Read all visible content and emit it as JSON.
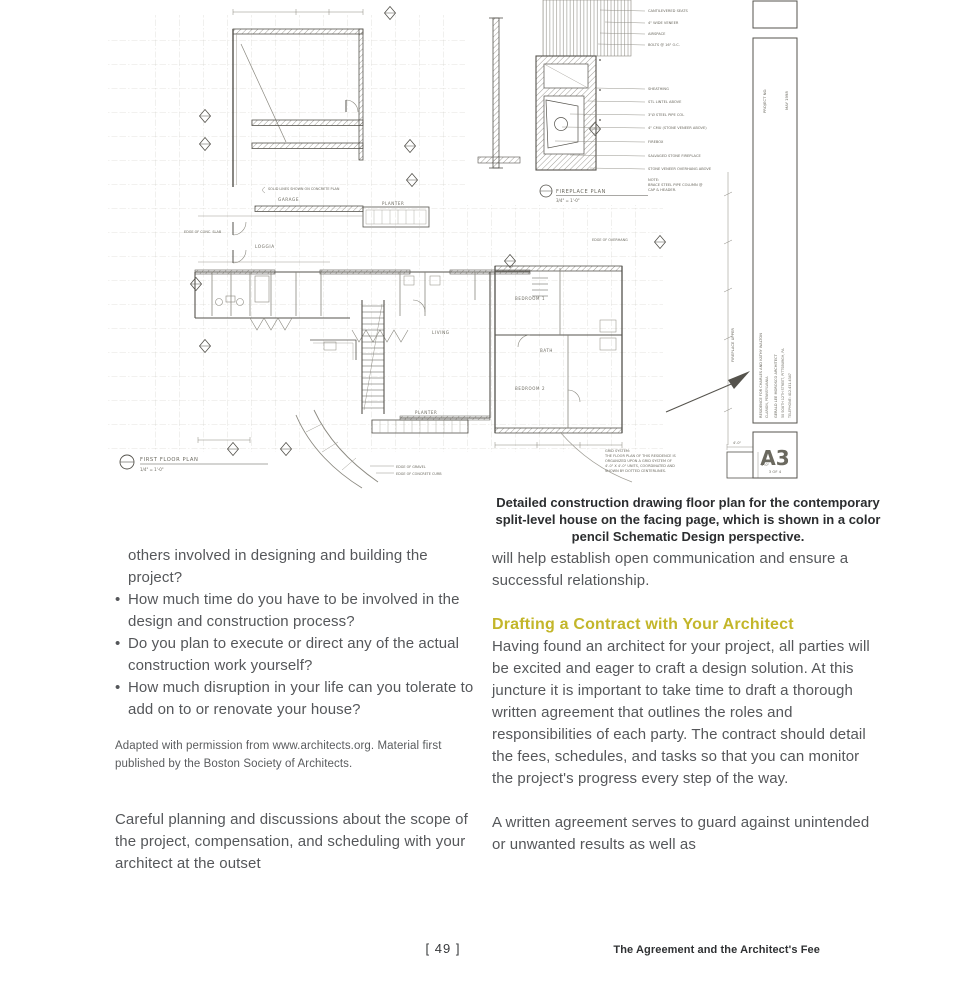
{
  "caption": "Detailed construction drawing floor plan for the contemporary split-level house on the facing page, which is shown in a color pencil Schematic Design perspective.",
  "left_column": {
    "intro": "others involved in designing and building the project?",
    "bullets": [
      "How much time do you have to be involved in the design and construction process?",
      "Do you plan to execute or direct any of the actual construction work yourself?",
      "How much disruption in your life can you tolerate to add on to or renovate your house?"
    ],
    "attribution": "Adapted with permission from www.architects.org. Material first published by the Boston Society of Architects.",
    "paragraph": "Careful planning and discussions about the scope of the project, compensation, and scheduling with your architect at the outset"
  },
  "right_column": {
    "paragraph1": "will help establish open communication and ensure a successful relationship.",
    "heading": "Drafting a Contract with Your Architect",
    "paragraph2": "Having found an architect for your project, all parties will be excited and eager to craft a design solution. At this juncture it is important to take time to draft a thorough written agreement that outlines the roles and responsibilities of each party. The contract should detail the fees, schedules, and tasks so that you can monitor the project's progress every step of the way.",
    "paragraph3": "A written agreement serves to guard against unintended or unwanted results as well as"
  },
  "footer": {
    "page_number": "[ 49 ]",
    "running_title": "The Agreement and the Architect's Fee"
  },
  "colors": {
    "heading_accent": "#c3b62a",
    "body_text": "#55575a",
    "pencil_dark": "#55534d",
    "pencil_light": "#a09e96"
  },
  "drawing": {
    "rooms": {
      "garage": "GARAGE",
      "planter_upper": "PLANTER",
      "loggia": "LOGGIA",
      "living": "LIVING",
      "planter_lower": "PLANTER",
      "bedroom1": "BEDROOM 1",
      "bath": "BATH",
      "bedroom2": "BEDROOM 2"
    },
    "plan_label": {
      "title": "FIRST FLOOR PLAN",
      "scale": "1/4\" = 1'-0\""
    },
    "fireplace_label": {
      "title": "FIREPLACE PLAN",
      "scale": "3/4\" = 1'-0\""
    },
    "fireplace_notes": [
      "CANTILEVERED SEATS",
      "4\" WIDE VENEER",
      "AIRSPACE",
      "BOLTS @ 16\" O.C.",
      "SHEATHING",
      "STL LINTEL ABOVE",
      "3\"Ø STEEL PIPE COL",
      "4\" CMU (STONE VENEER ABOVE)",
      "FIREBOX",
      "SALVAGED STONE FIREPLACE",
      "STONE VENEER OVERHANG ABOVE"
    ],
    "fireplace_note_footer": [
      "NOTE:",
      "BRACE STEEL PIPE COLUMN @",
      "CAP & HEADER."
    ],
    "grid_note": [
      "GRID SYSTEM:",
      "THE FLOOR PLAN OF THIS RESIDENCE IS",
      "ORGANIZED UPON A GRID SYSTEM OF",
      "4'-0\" X 4'-0\" UNITS, COORDINATED AND",
      "SHOWN BY DOTTED CENTERLINES."
    ],
    "unit_dim": "4'-0\"",
    "dim_rotated": "FIREPLACE UPPER",
    "site_notes": {
      "slab": "EDGE OF CONC. SLAB",
      "solid": "SOLID LINES SHOWN ON CONCRETE PLAN",
      "overhang": "EDGE OF OVERHANG",
      "gravel": "EDGE OF GRAVEL",
      "curb": "EDGE OF CONCRETE CURB"
    },
    "titleblock": {
      "project": "PROJECT NO.",
      "date": "MAY 1998",
      "line1": "RESIDENCE FOR CHARLES AND KATHY WALTON",
      "line2": "CLARION, PENNSYLVANIA",
      "line3": "GERALD LEE MOROSCO ARCHITECT",
      "line4": "50 SOUTH 12TH STREET, PITTSBURGH, PA",
      "line5": "TELEPHONE: 412.431.4347",
      "sheet": "A3",
      "sheet_of": "3 OF 4"
    }
  }
}
